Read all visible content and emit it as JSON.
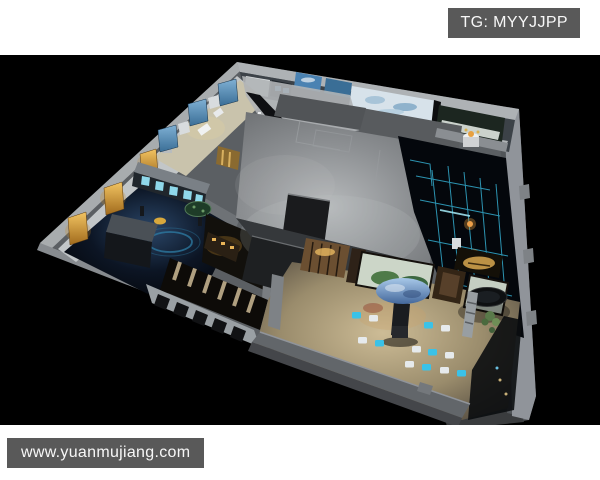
{
  "page": {
    "width": 600,
    "height": 480,
    "background": "#ffffff",
    "canvas_background": "#000000"
  },
  "overlays": {
    "tg_label": {
      "text": "TG: MYYJJPP"
    },
    "watermark": {
      "text": "www.yuanmujiang.com"
    }
  },
  "scene": {
    "subject": "3D cutaway floor-plan render of an exhibition hall viewed from above",
    "colors": {
      "overlay_bar": "#595959",
      "overlay_text": "#f7f7f7",
      "wall_gray": "#5b5f63",
      "wall_light": "#aeb2b5",
      "roof_gray": "#8c8f92",
      "accent_cyan": "#3ac2e8",
      "accent_amber": "#e0a844",
      "mural_blue": "#4a82b2",
      "mural_green": "#4e7a48",
      "warm_floor": "#b3a383",
      "cloud_blue": "#6f9fd0"
    }
  }
}
